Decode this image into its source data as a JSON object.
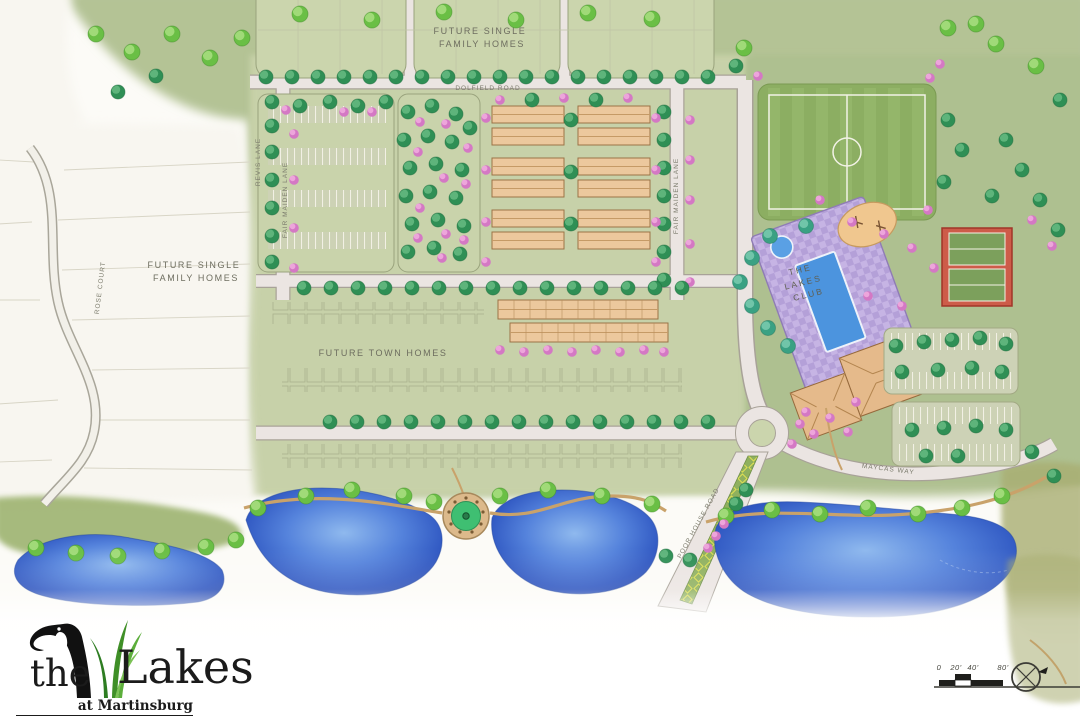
{
  "plan": {
    "labels": {
      "future_top_1": "FUTURE SINGLE",
      "future_top_2": "FAMILY HOMES",
      "future_left_1": "FUTURE SINGLE",
      "future_left_2": "FAMILY HOMES",
      "future_town": "FUTURE TOWN HOMES",
      "club_1": "THE",
      "club_2": "LAKES",
      "club_3": "CLUB"
    },
    "roads": {
      "dolfield": "DOLFIELD ROAD",
      "revis": "REVIS LANE",
      "fair_maiden_w": "FAIR MAIDEN LANE",
      "fair_maiden_e": "FAIR MAIDEN LANE",
      "rose_court": "ROSE COURT",
      "poor_house": "POOR HOUSE ROAD",
      "maycas": "MAYCAS WAY"
    },
    "scale": {
      "zero": "0",
      "twenty": "20'",
      "forty": "40'",
      "eighty": "80'"
    }
  },
  "logo": {
    "the": "the",
    "lakes": "Lakes",
    "subtitle": "at Martinsburg",
    "tagline": "Berkeley County, West Virginia"
  },
  "colors": {
    "lake_blue": "#3b62c8",
    "canopy_green": "#2f8f55",
    "flowering_pink": "#d478c4",
    "club_deck_lavender": "#c0aede",
    "tennis_red": "#cd5c49",
    "field_green": "#8cae62"
  }
}
